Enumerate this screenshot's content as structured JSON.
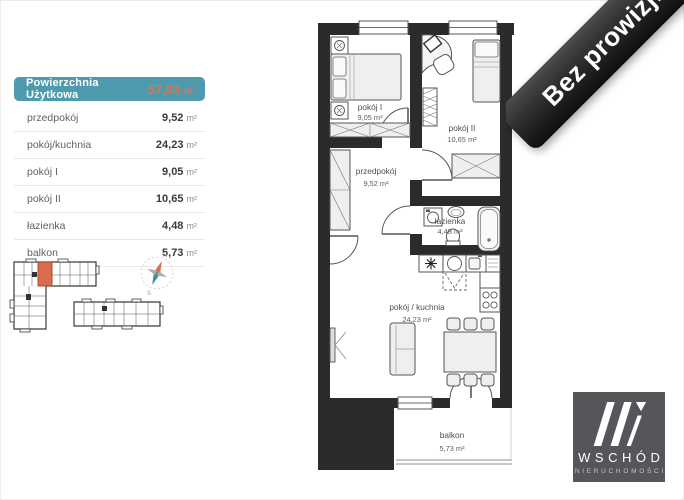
{
  "area_table": {
    "header": {
      "label": "Powierzchnia Użytkowa",
      "value": "57,93",
      "unit": "m²"
    },
    "rows": [
      {
        "label": "przedpokój",
        "value": "9,52",
        "unit": "m²"
      },
      {
        "label": "pokój/kuchnia",
        "value": "24,23",
        "unit": "m²"
      },
      {
        "label": "pokój I",
        "value": "9,05",
        "unit": "m²"
      },
      {
        "label": "pokój II",
        "value": "10,65",
        "unit": "m²"
      },
      {
        "label": "łazienka",
        "value": "4,48",
        "unit": "m²"
      },
      {
        "label": "balkon",
        "value": "5,73",
        "unit": "m²"
      }
    ]
  },
  "floor_plan": {
    "rooms": [
      {
        "name": "pokój I",
        "area": "9,05 m²"
      },
      {
        "name": "pokój II",
        "area": "10,65 m²"
      },
      {
        "name": "przedpokój",
        "area": "9,52 m²"
      },
      {
        "name": "łazienka",
        "area": "4,48 m²"
      },
      {
        "name": "pokój / kuchnia",
        "area": "24,23 m²"
      },
      {
        "name": "balkon",
        "area": "5,73 m²"
      }
    ]
  },
  "site_plan": {
    "compass": {
      "north": "N",
      "south": "S"
    }
  },
  "ribbon": {
    "label": "Bez prowizji"
  },
  "logo": {
    "name": "WSCHÓD",
    "subtitle": "NIERUCHOMOŚCI"
  },
  "colors": {
    "table_header_bg": "#4E9AAE",
    "total_area_text": "#E0714E",
    "walls": "#2b2b2b",
    "highlighted_unit": "#D96C4A",
    "compass_north": "#D96C4A",
    "compass_south": "#3F8FA2",
    "ribbon_bg": "#1f1f21",
    "logo_bg": "#55565A"
  }
}
